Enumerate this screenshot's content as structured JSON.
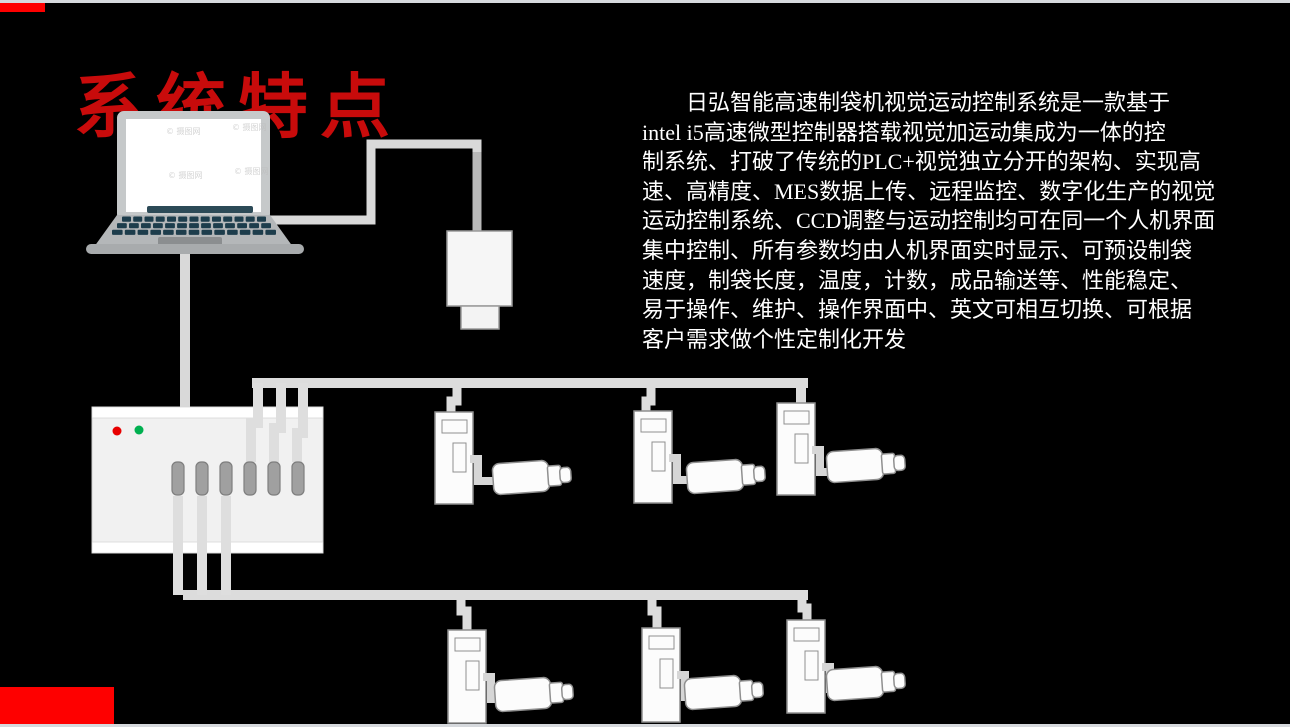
{
  "slide": {
    "title": "系统特点",
    "paragraph": "　　日弘智能高速制袋机视觉运动控制系统是一款基于\nintel i5高速微型控制器搭载视觉加运动集成为一体的控\n制系统、打破了传统的PLC+视觉独立分开的架构、实现高\n速、高精度、MES数据上传、远程监控、数字化生产的视觉\n运动控制系统、CCD调整与运动控制均可在同一个人机界面\n集中控制、所有参数均由人机界面实时显示、可预设制袋\n速度，制袋长度，温度，计数，成品输送等、性能稳定、\n易于操作、维护、操作界面中、英文可相互切换、可根据\n客户需求做个性定制化开发",
    "colors": {
      "background": "#000000",
      "title_red": "#c80b0b",
      "accent_red": "#fe0000",
      "edge_strip": "#d6d9dd",
      "text_white": "#ffffff",
      "cable_gray": "#d9d9d9",
      "cable_dark_gray": "#b9b9b9",
      "device_fill": "#fcfcfc",
      "device_stroke": "#8f8f8f",
      "controller_body": "#f1f1f1",
      "led_red": "#e80000",
      "led_green": "#00b050",
      "connector_slot": "#a0a0a0",
      "laptop_frame": "#c6c9ca",
      "laptop_key": "#1d3d4c"
    }
  },
  "diagram": {
    "watermark": "© 摄图网"
  }
}
